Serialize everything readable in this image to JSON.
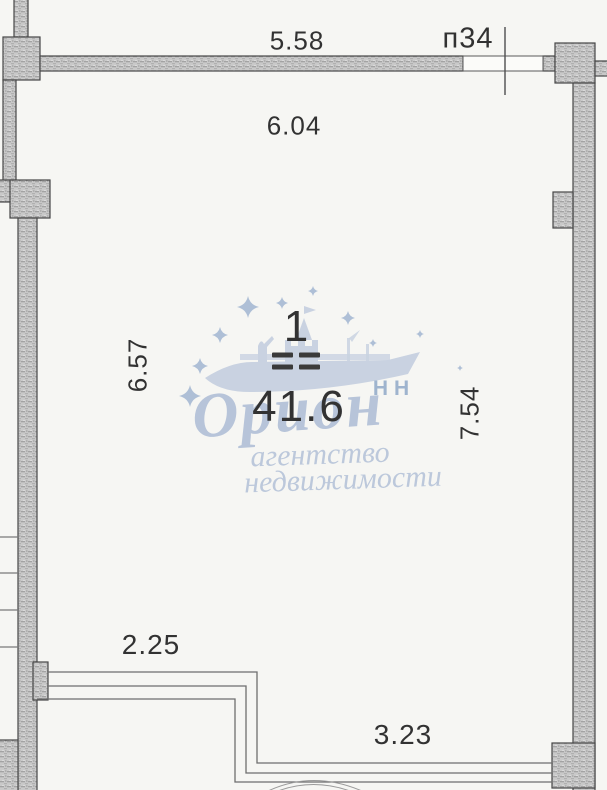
{
  "plan": {
    "apartment_label": "п34",
    "room": {
      "number": "1",
      "area": "41.6"
    },
    "dimensions": {
      "top_exterior": "5.58",
      "top_interior": "6.04",
      "left": "6.57",
      "right": "7.54",
      "bottom_left": "2.25",
      "bottom": "3.23"
    }
  },
  "watermark": {
    "brand": "Орион",
    "brand_suffix": "НН",
    "tagline_line1": "агентство",
    "tagline_line2": "недвижимости"
  },
  "colors": {
    "wall_fill": "#c9c9c9",
    "wall_outline": "#474747",
    "dimension_text": "#323232",
    "watermark_blue": "#bcc8db",
    "watermark_accent": "#9fb4ce",
    "background": "#f6f6f3"
  }
}
